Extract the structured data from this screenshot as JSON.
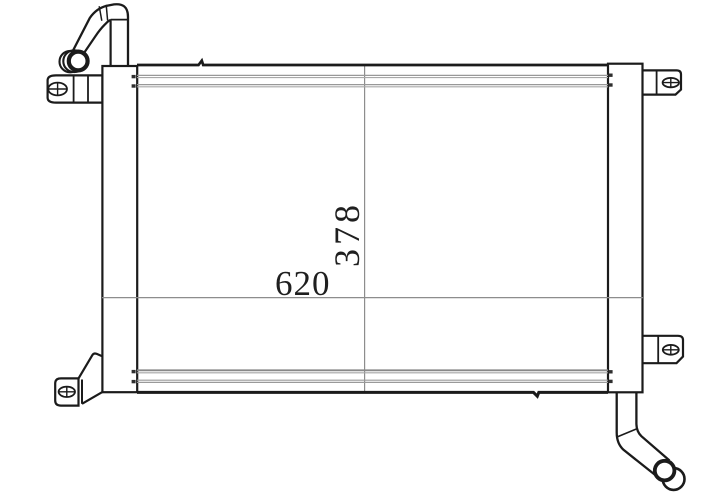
{
  "drawing": {
    "labels": {
      "width": "620",
      "height": "378"
    },
    "colors": {
      "outline": "#1b1b1b",
      "fin_lines": "#9a9a9a",
      "dimension_lines": "#8d8d8d",
      "label_text": "#1f1f1f",
      "background": "#ffffff"
    }
  }
}
